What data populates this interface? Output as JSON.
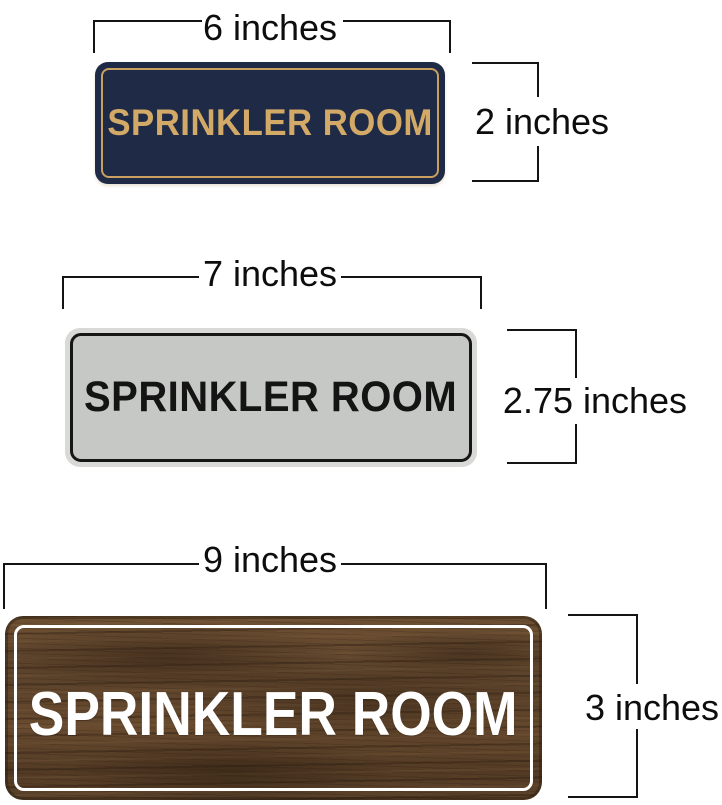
{
  "title": "Sprinkler Room sign size comparison diagram",
  "annotation": {
    "line_color": "#141414",
    "label_color": "#0d0d0d"
  },
  "signs": [
    {
      "name": "navy-gold-sign",
      "text": "SPRINKLER ROOM",
      "width_label": "6 inches",
      "height_label": "2 inches",
      "plate_color": "#1e2a46",
      "accent_color": "#d2a966"
    },
    {
      "name": "silver-black-sign",
      "text": "SPRINKLER ROOM",
      "width_label": "7 inches",
      "height_label": "2.75 inches",
      "plate_color": "#c6c8c5",
      "accent_color": "#161616"
    },
    {
      "name": "walnut-white-sign",
      "text": "SPRINKLER ROOM",
      "width_label": "9 inches",
      "height_label": "3 inches",
      "plate_color": "#5c432b",
      "accent_color": "#ffffff"
    }
  ]
}
